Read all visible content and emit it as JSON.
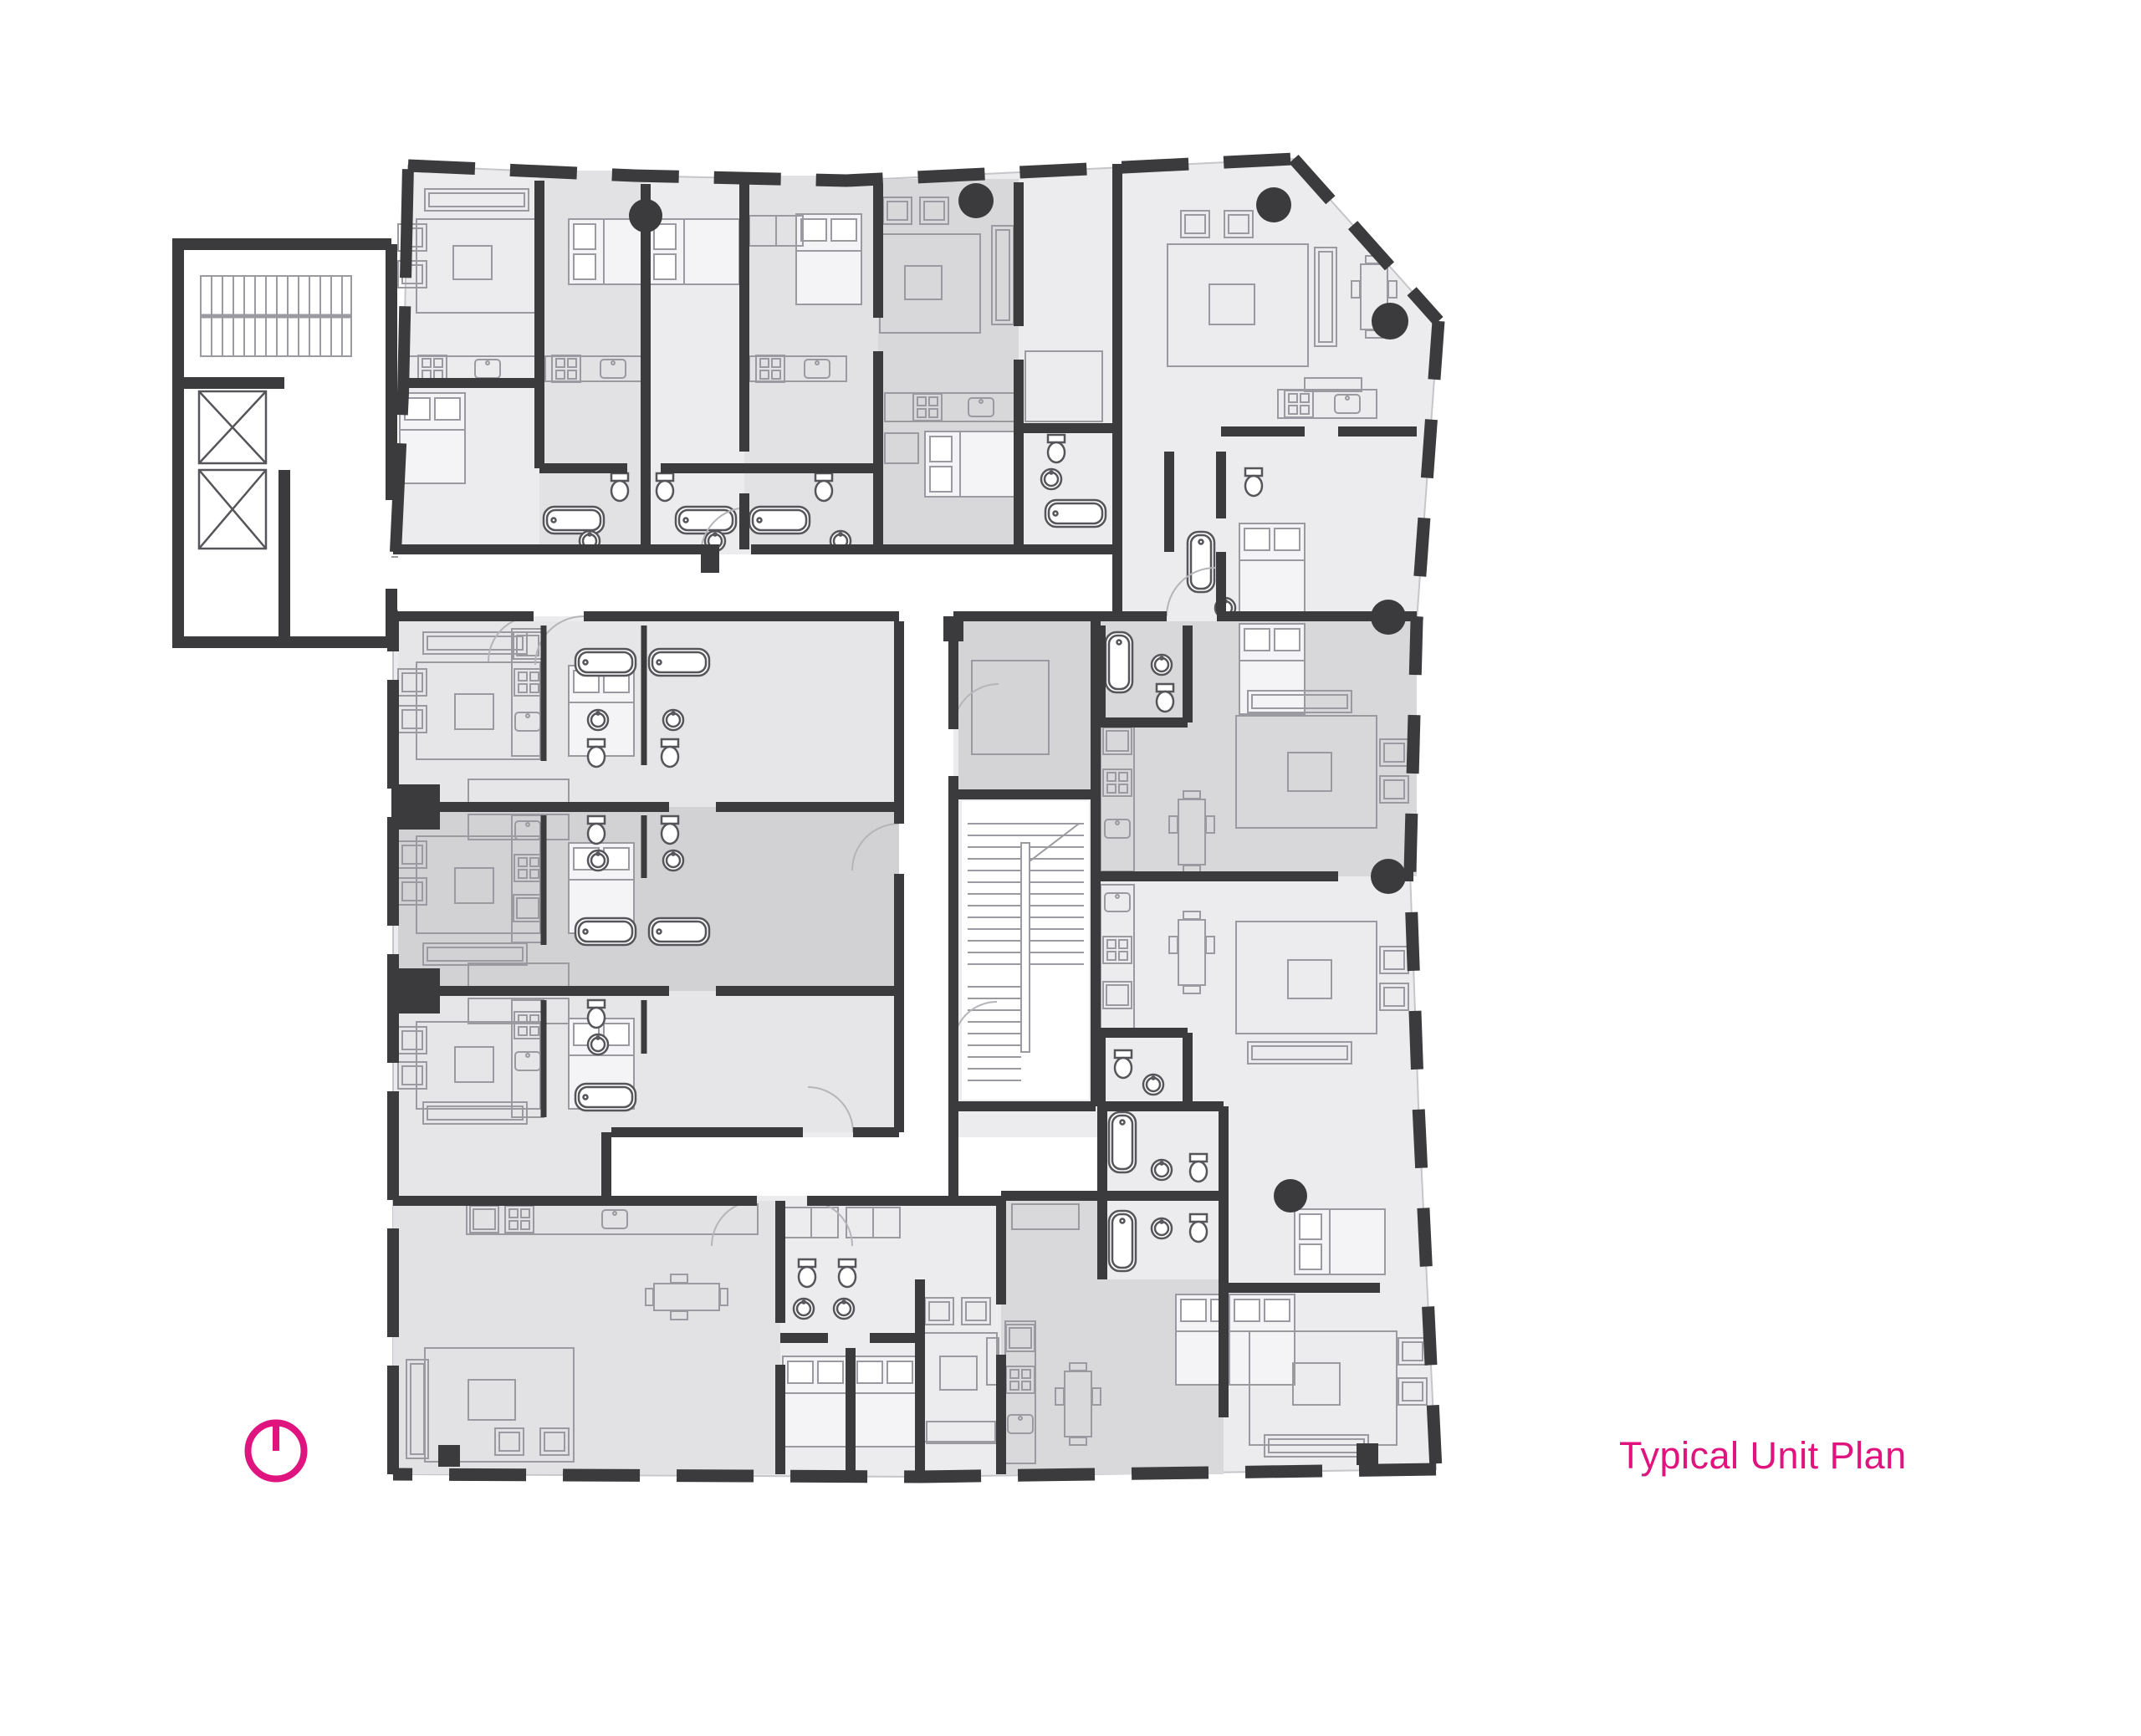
{
  "title": {
    "label": "Typical Unit Plan",
    "color": "#e0147e"
  },
  "north_arrow": {
    "icon": "north-arrow-icon",
    "color": "#e0147e"
  },
  "palette": {
    "wall": "#3b3b3d",
    "floor_base": "#ececee",
    "floor_mid": "#e2e2e4",
    "floor_dark": "#d8d8da",
    "floor_darker": "#d2d2d4",
    "corridor": "#ffffff",
    "furniture_line": "#9a9aa0",
    "fixture_line": "#55555a",
    "outline": "#c6c6ca",
    "background": "#ffffff"
  },
  "drawing": {
    "type": "architectural-floor-plan",
    "features": [
      "residential units",
      "corridors",
      "two stair cores",
      "two elevators",
      "kitchens",
      "bathrooms",
      "bedrooms",
      "living rooms",
      "round structural columns"
    ]
  }
}
